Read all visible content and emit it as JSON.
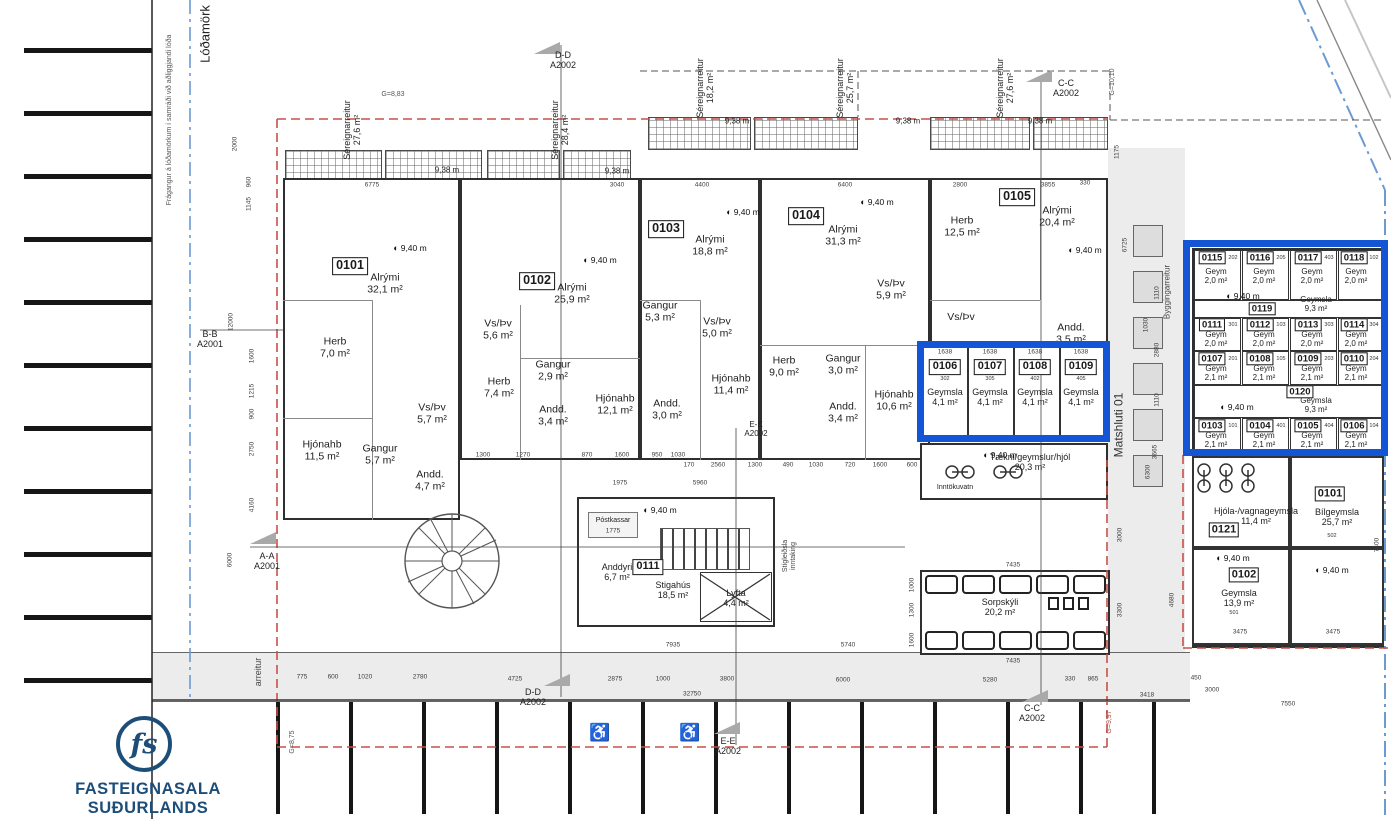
{
  "branding": {
    "monogram": "fs",
    "name": "FASTEIGNASALA SUÐURLANDS"
  },
  "icons": {
    "level": "◐",
    "accessible": "♿"
  },
  "markers": {
    "m940": "9,40 m",
    "m938": "9,38 m"
  },
  "boundaries": {
    "lodamork": "Lóðamörk",
    "note": "Frágangur á lóðamörkum í samráði við aðliggjandi lóða",
    "matshluti": "Matshluti 01",
    "byggingarreitur": "Byggingarreitur",
    "arreitur": "arreitur",
    "g883": "G=8,83",
    "g1010": "G=10,10",
    "g997": "G=9,97",
    "g875": "G=8,75"
  },
  "sections": {
    "dd": "D-D\nA2002",
    "cc": "C-C\nA2002",
    "ee": "E-E\nA2002",
    "aa": "A-A\nA2001",
    "bb": "B-B\nA2001"
  },
  "sereign": [
    "Séreignarreitur\n27,6 m²",
    "Séreignarreitur\n28,4 m²",
    "Séreignarreitur\n18,2 m²",
    "Séreignarreitur\n25,7 m²",
    "Séreignarreitur\n27,6 m²"
  ],
  "apartments": [
    {
      "id": "0101",
      "rooms": [
        "Alrými\n32,1 m²",
        "Herb\n7,0 m²",
        "Vs/Þv\n5,7 m²",
        "Hjónahb\n11,5 m²",
        "Gangur\n5,7 m²",
        "Andd.\n4,7 m²"
      ]
    },
    {
      "id": "0102",
      "rooms": [
        "Alrými\n25,9 m²",
        "Vs/Þv\n5,6 m²",
        "Herb\n7,4 m²",
        "Gangur\n2,9 m²",
        "Hjónahb\n12,1 m²",
        "Andd.\n3,4 m²"
      ]
    },
    {
      "id": "0103",
      "rooms": [
        "Alrými\n18,8 m²",
        "Gangur\n5,3 m²",
        "Vs/Þv\n5,0 m²",
        "Hjónahb\n11,4 m²",
        "Andd.\n3,0 m²"
      ]
    },
    {
      "id": "0104",
      "rooms": [
        "Alrými\n31,3 m²",
        "Vs/Þv\n5,9 m²",
        "Herb\n9,0 m²",
        "Gangur\n3,0 m²",
        "Hjónahb\n10,6 m²",
        "Andd.\n3,4 m²"
      ]
    },
    {
      "id": "0105",
      "rooms": [
        "Herb\n12,5 m²",
        "Alrými\n20,4 m²",
        "Vs/Þv",
        "Andd.\n3,5 m²"
      ]
    }
  ],
  "storage_strip": {
    "dim": "1638",
    "units": [
      {
        "id": "0106",
        "sub": "302",
        "label": "Geymsla\n4,1 m²"
      },
      {
        "id": "0107",
        "sub": "305",
        "label": "Geymsla\n4,1 m²"
      },
      {
        "id": "0108",
        "sub": "402",
        "label": "Geymsla\n4,1 m²"
      },
      {
        "id": "0109",
        "sub": "405",
        "label": "Geymsla\n4,1 m²"
      }
    ]
  },
  "taekni": {
    "label": "Tækni/geymslur/hjól\n20,3 m²",
    "inntak": "Inntökuvatn"
  },
  "stairs": {
    "postkassar": "Póstkassar",
    "anddyri": "Anddyri\n6,7 m²",
    "unit": "0111",
    "stigahus": "Stigahús\n18,5 m²",
    "lyfta": "Lyfta\n4,4 m²",
    "pipe": "Stígleiðsla\ninntaking"
  },
  "sorpskyli": {
    "label": "Sorpskýli\n20,2 m²"
  },
  "annex": {
    "rows": [
      [
        {
          "id": "0115",
          "sub": "202",
          "label": "Geym\n2,0 m²"
        },
        {
          "id": "0116",
          "sub": "205",
          "label": "Geym\n2,0 m²"
        },
        {
          "id": "0117",
          "sub": "403",
          "label": "Geym\n2,0 m²"
        },
        {
          "id": "0118",
          "sub": "102",
          "label": "Geym\n2,0 m²"
        }
      ],
      [
        {
          "id": "0111",
          "sub": "301",
          "label": "Geym\n2,0 m²"
        },
        {
          "id": "0112",
          "sub": "103",
          "label": "Geym\n2,0 m²"
        },
        {
          "id": "0113",
          "sub": "303",
          "label": "Geym\n2,0 m²"
        },
        {
          "id": "0114",
          "sub": "304",
          "label": "Geym\n2,0 m²"
        }
      ],
      [
        {
          "id": "0107",
          "sub": "201",
          "label": "Geym\n2,1 m²"
        },
        {
          "id": "0108",
          "sub": "105",
          "label": "Geym\n2,1 m²"
        },
        {
          "id": "0109",
          "sub": "203",
          "label": "Geym\n2,1 m²"
        },
        {
          "id": "0110",
          "sub": "204",
          "label": "Geym\n2,1 m²"
        }
      ],
      [
        {
          "id": "0103",
          "sub": "101",
          "label": "Geym\n2,1 m²"
        },
        {
          "id": "0104",
          "sub": "401",
          "label": "Geym\n2,1 m²"
        },
        {
          "id": "0105",
          "sub": "404",
          "label": "Geym\n2,1 m²"
        },
        {
          "id": "0106",
          "sub": "104",
          "label": "Geym\n2,1 m²"
        }
      ]
    ],
    "mid": [
      {
        "id": "0119",
        "label": "Geymsla\n9,3 m²"
      },
      {
        "id": "0120",
        "label": "Geymsla\n9,3 m²"
      }
    ],
    "lower": [
      {
        "id": "0121",
        "label": "Hjóla-/vagnageymsla\n11,4 m²"
      },
      {
        "id": "0101",
        "sub": "502",
        "label": "Bílgeymsla\n25,7 m²"
      },
      {
        "id": "0102",
        "sub": "501",
        "label": "Geymsla\n13,9 m²"
      }
    ]
  },
  "dims": {
    "top": [
      "6775",
      "3040",
      "4400",
      "6400",
      "2800",
      "3855",
      "330"
    ],
    "mid1": [
      "1300",
      "1270",
      "870",
      "1600",
      "950",
      "1030"
    ],
    "mid2": [
      "170",
      "2560",
      "1300",
      "490",
      "1030",
      "720",
      "1600",
      "600"
    ],
    "bottom": [
      "775",
      "600",
      "1020",
      "2780",
      "4725",
      "2875",
      "1000",
      "3800",
      "6000",
      "5280",
      "330",
      "865",
      "450",
      "3418",
      "3000",
      "7550",
      "32750"
    ],
    "left": [
      "2000",
      "960",
      "1145",
      "12000",
      "1600",
      "1215",
      "900",
      "2750",
      "4160",
      "6000"
    ],
    "right": [
      "1175",
      "6725",
      "1110",
      "1030",
      "2880",
      "1110",
      "3665",
      "6300",
      "3000"
    ],
    "stair": [
      "1975",
      "5960",
      "7935",
      "5740",
      "1775"
    ],
    "sorp": [
      "7435",
      "7435",
      "1000",
      "1300",
      "1600",
      "3300",
      "4680"
    ],
    "annex": [
      "3475",
      "3475",
      "7400"
    ]
  }
}
